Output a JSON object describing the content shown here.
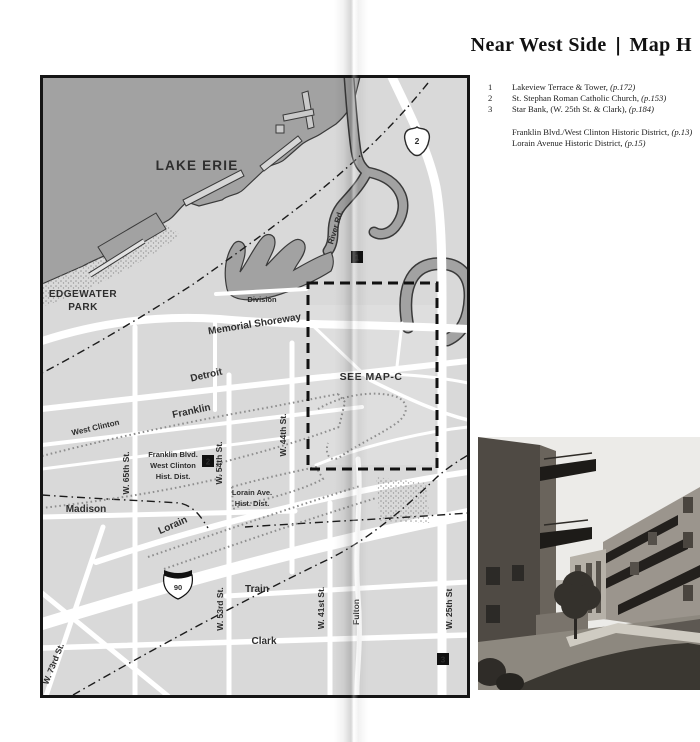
{
  "header": {
    "title_left": "Near West Side",
    "separator": "|",
    "title_right": "Map H"
  },
  "legend": {
    "numbered": [
      {
        "num": "1",
        "name": "Lakeview Terrace & Tower,",
        "page": "(p.172)"
      },
      {
        "num": "2",
        "name": "St. Stephan Roman Catholic Church,",
        "page": "(p.153)"
      },
      {
        "num": "3",
        "name": "Star Bank, (W. 25th St. & Clark),",
        "page": "(p.184)"
      }
    ],
    "districts": [
      {
        "name": "Franklin Blvd./West Clinton Historic District,",
        "page": "(p.13)"
      },
      {
        "name": "Lorain Avenue Historic District,",
        "page": "(p.15)"
      }
    ]
  },
  "map": {
    "labels": {
      "lake_erie": "LAKE ERIE",
      "edgewater_line1": "EDGEWATER",
      "edgewater_line2": "PARK",
      "memorial_shoreway": "Memorial Shoreway",
      "division": "Division",
      "detroit": "Detroit",
      "franklin": "Franklin",
      "west_clinton": "West Clinton",
      "madison": "Madison",
      "lorain": "Lorain",
      "train": "Train",
      "clark": "Clark",
      "fulton": "Fulton",
      "river_rd": "River Rd.",
      "see_map_c": "SEE MAP-C",
      "w65": "W. 65th St.",
      "w54": "W. 54th St.",
      "w44": "W. 44th St.",
      "w73": "W. 73rd St.",
      "w53": "W. 53rd St.",
      "w41": "W. 41st St.",
      "w25": "W. 25th St",
      "franklin_dist_line1": "Franklin Blvd.",
      "franklin_dist_line2": "West Clinton",
      "franklin_dist_line3": "Hist. Dist.",
      "lorain_dist_line1": "Lorain Ave.",
      "lorain_dist_line2": "Hist. Dist.",
      "route2_shield": "2",
      "i90_shield": "90",
      "marker1": "1",
      "marker2": "2",
      "marker3": "3"
    },
    "colors": {
      "water": "#a2a2a2",
      "land": "#d9d9d9",
      "road": "#ffffff",
      "frame": "#151515"
    }
  }
}
